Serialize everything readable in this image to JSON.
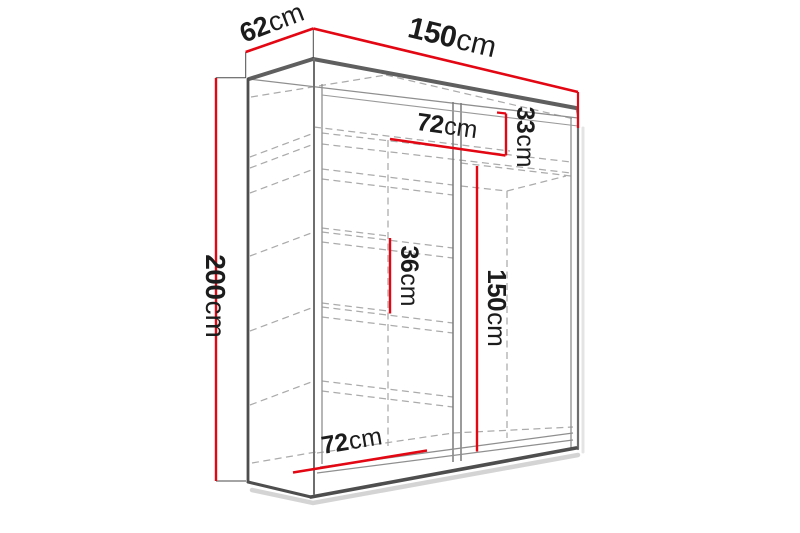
{
  "diagram": {
    "background": "#ffffff",
    "colors": {
      "dimension_red": "#e30613",
      "edge_dark": "#4e4e4e",
      "edge_medium": "#6e6e6e",
      "edge_thin": "#8f8f8f",
      "dashed_gray": "#ababab",
      "label_text": "#1c1c1c",
      "shadow_gray": "#cccccc"
    },
    "dimensions": {
      "width_top": {
        "value": "150",
        "unit": "cm"
      },
      "depth_top": {
        "value": "62",
        "unit": "cm"
      },
      "height_left": {
        "value": "200",
        "unit": "cm"
      },
      "shelf_width_top": {
        "value": "72",
        "unit": "cm"
      },
      "top_shelf_height": {
        "value": "33",
        "unit": "cm"
      },
      "shelf_gap": {
        "value": "36",
        "unit": "cm"
      },
      "hanging_space_height": {
        "value": "150",
        "unit": "cm"
      },
      "shelf_width_bottom": {
        "value": "72",
        "unit": "cm"
      }
    }
  }
}
